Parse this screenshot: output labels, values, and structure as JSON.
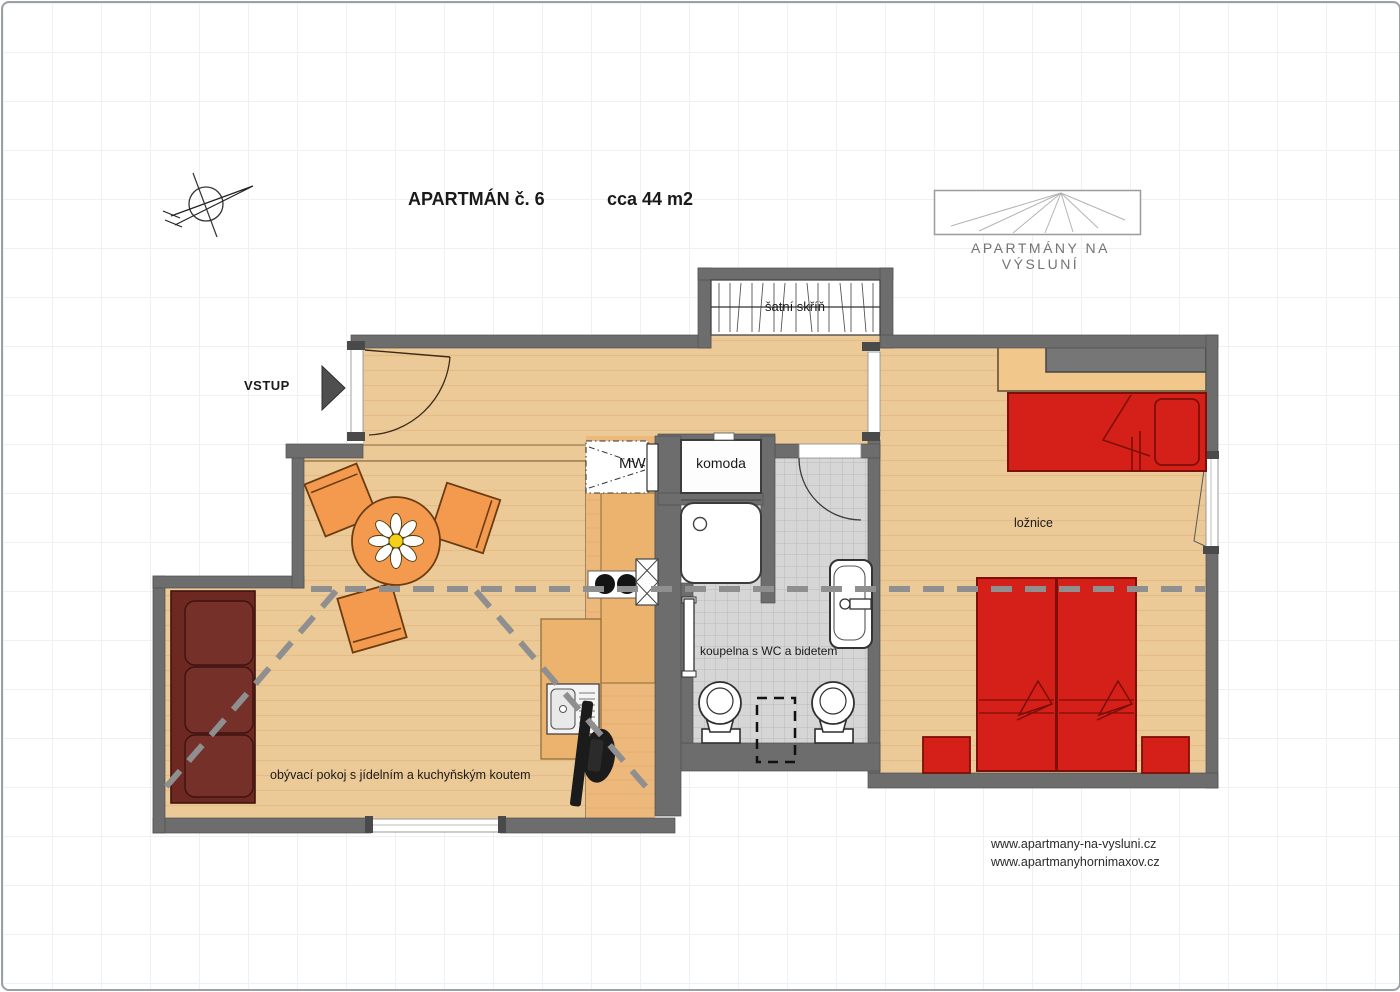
{
  "header": {
    "title": "APARTMÁN č. 6",
    "area": "cca 44 m2"
  },
  "logo": {
    "caption": "APARTMÁNY NA VÝSLUNÍ"
  },
  "plan": {
    "rooms": {
      "entrance_label": "VSTUP",
      "wardrobe": "šatní skříň",
      "microwave": "MW",
      "dresser": "komoda",
      "bathroom": "koupelna s WC a bidetem",
      "bedroom": "ložnice",
      "living_room": "obývací pokoj s jídelním a kuchyňským koutem"
    },
    "icons": {
      "compass": "compass-icon",
      "entrance_arrow": "arrow-right-icon",
      "logo_sun": "sun-rays-icon"
    }
  },
  "footer": {
    "websites": [
      "www.apartmany-na-vysluni.cz",
      "www.apartmanyhornimaxov.cz"
    ]
  },
  "colors": {
    "wall": "#6d6d6d",
    "floor_wood": "#ecca97",
    "floor_kitchen": "#edb87c",
    "tile": "#d6d6d6",
    "furniture_orange": "#f49a4f",
    "bed_red": "#d42019",
    "sofa_maroon": "#6e2822",
    "section_line": "#8f8f8f"
  }
}
